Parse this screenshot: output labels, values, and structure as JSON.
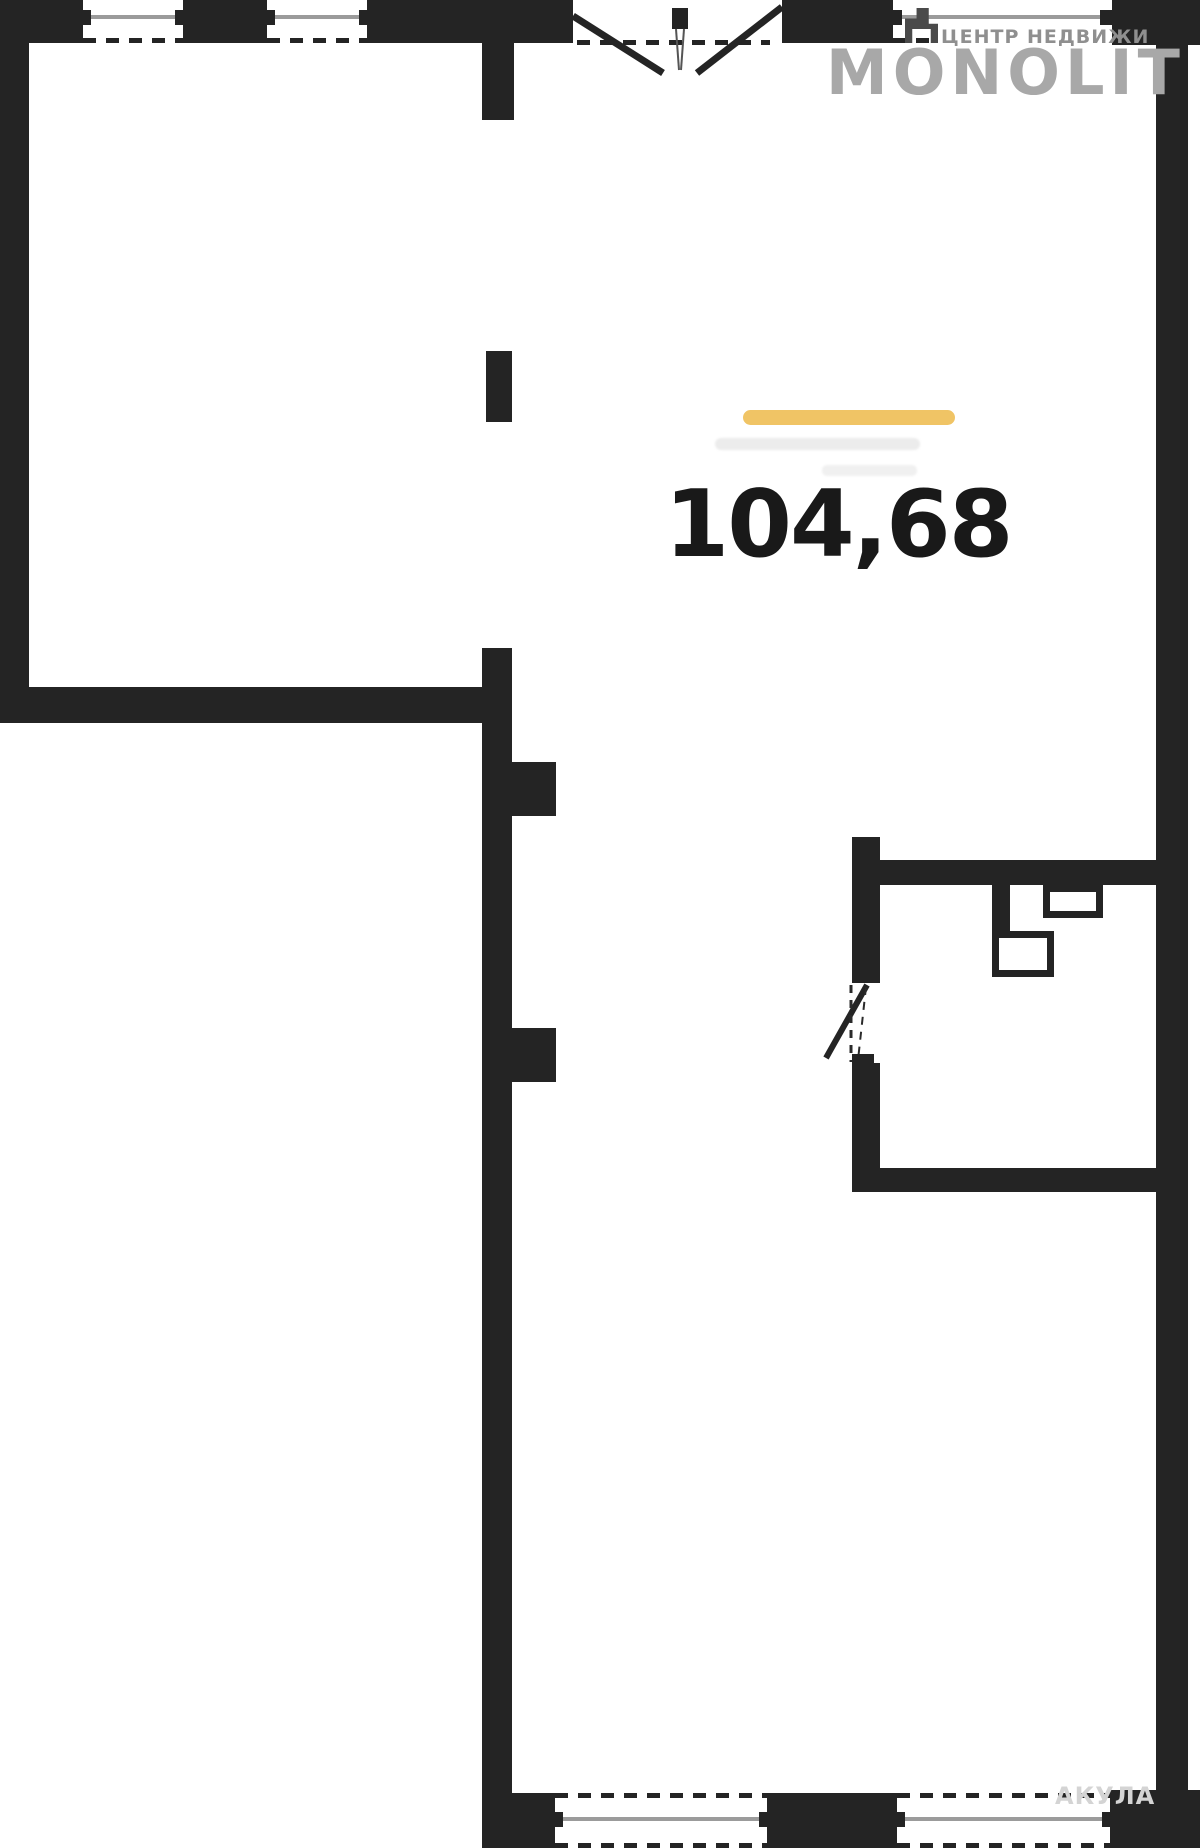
{
  "header": {
    "brand": "MONOLIT",
    "tagline": "ЦЕНТР НЕДВИЖИ",
    "brand_color": "#a8a8a8",
    "tagline_color": "#8f8f8f"
  },
  "plan": {
    "area_label": "104,68",
    "accent_bar_color": "#f0c465",
    "wall_color": "#242424",
    "window_glass_color": "#9b9b9b"
  },
  "footer": {
    "agent_watermark": "АКУЛА",
    "watermark_color": "#d4d4d4"
  }
}
